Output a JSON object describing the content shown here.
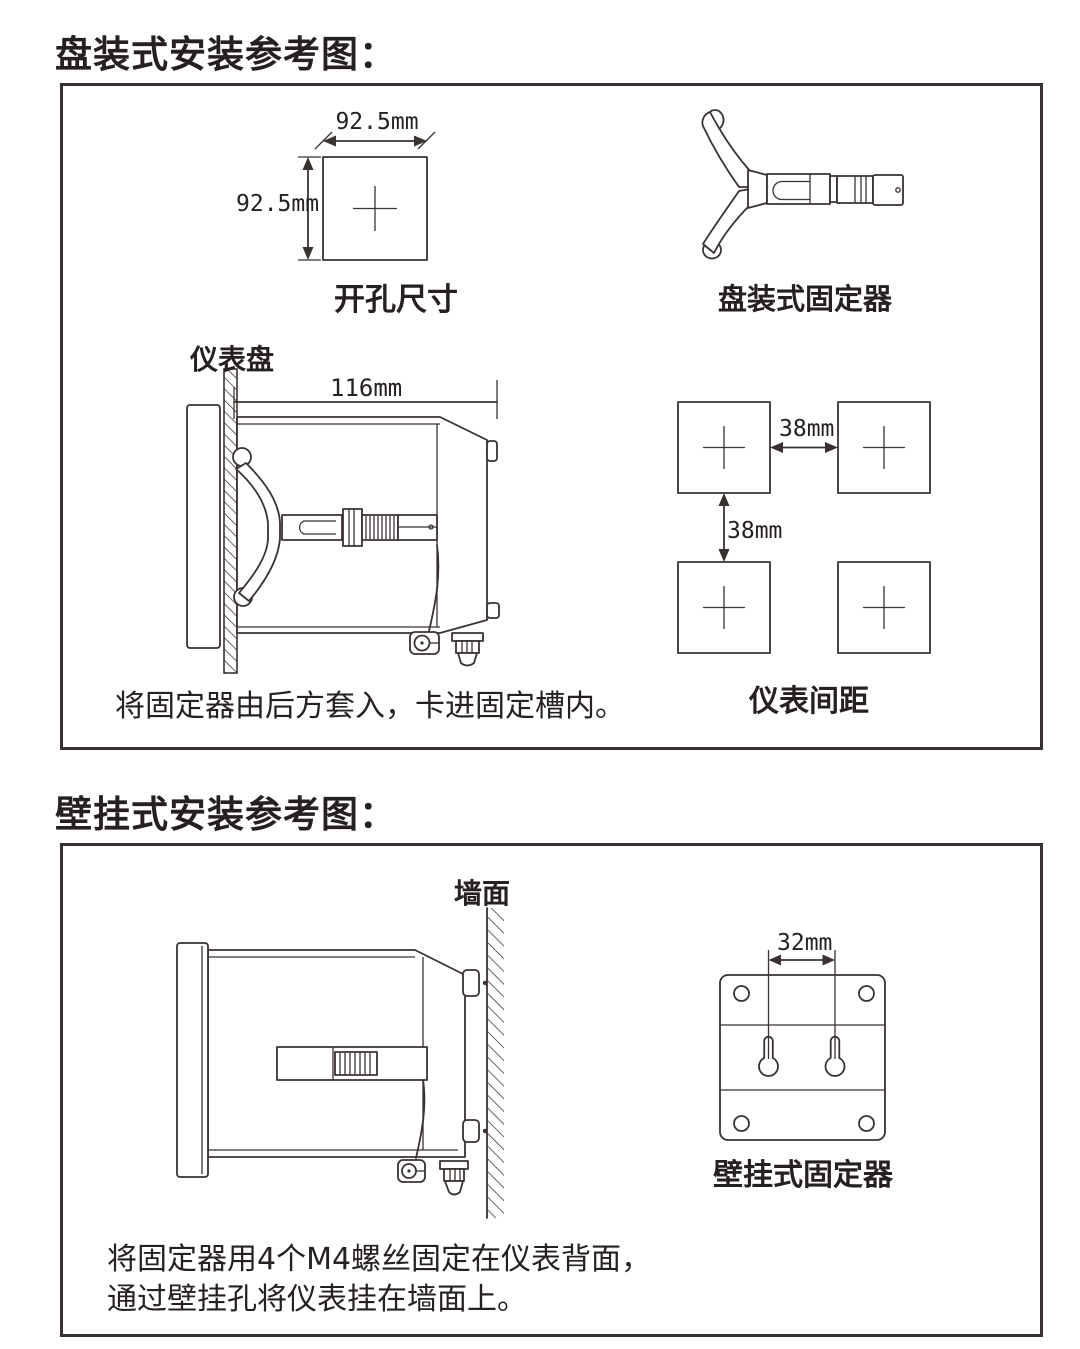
{
  "page": {
    "background": "#ffffff",
    "ink": "#3a3230",
    "text_color": "#262020"
  },
  "panel_section": {
    "title": "盘装式安装参考图：",
    "cutout_diagram": {
      "width_dim": "92.5mm",
      "height_dim": "92.5mm",
      "label": "开孔尺寸"
    },
    "fixer_diagram": {
      "label": "盘装式固定器"
    },
    "sideview_diagram": {
      "panel_label": "仪表盘",
      "depth_dim": "116mm",
      "caption": "将固定器由后方套入，卡进固定槽内。"
    },
    "spacing_diagram": {
      "h_gap_dim": "38mm",
      "v_gap_dim": "38mm",
      "label": "仪表间距"
    }
  },
  "wall_section": {
    "title": "壁挂式安装参考图：",
    "sideview_diagram": {
      "wall_label": "墙面"
    },
    "bracket_diagram": {
      "hole_gap_dim": "32mm",
      "label": "壁挂式固定器"
    },
    "caption_lines": [
      "将固定器用4个M4螺丝固定在仪表背面，",
      "通过壁挂孔将仪表挂在墙面上。"
    ]
  }
}
